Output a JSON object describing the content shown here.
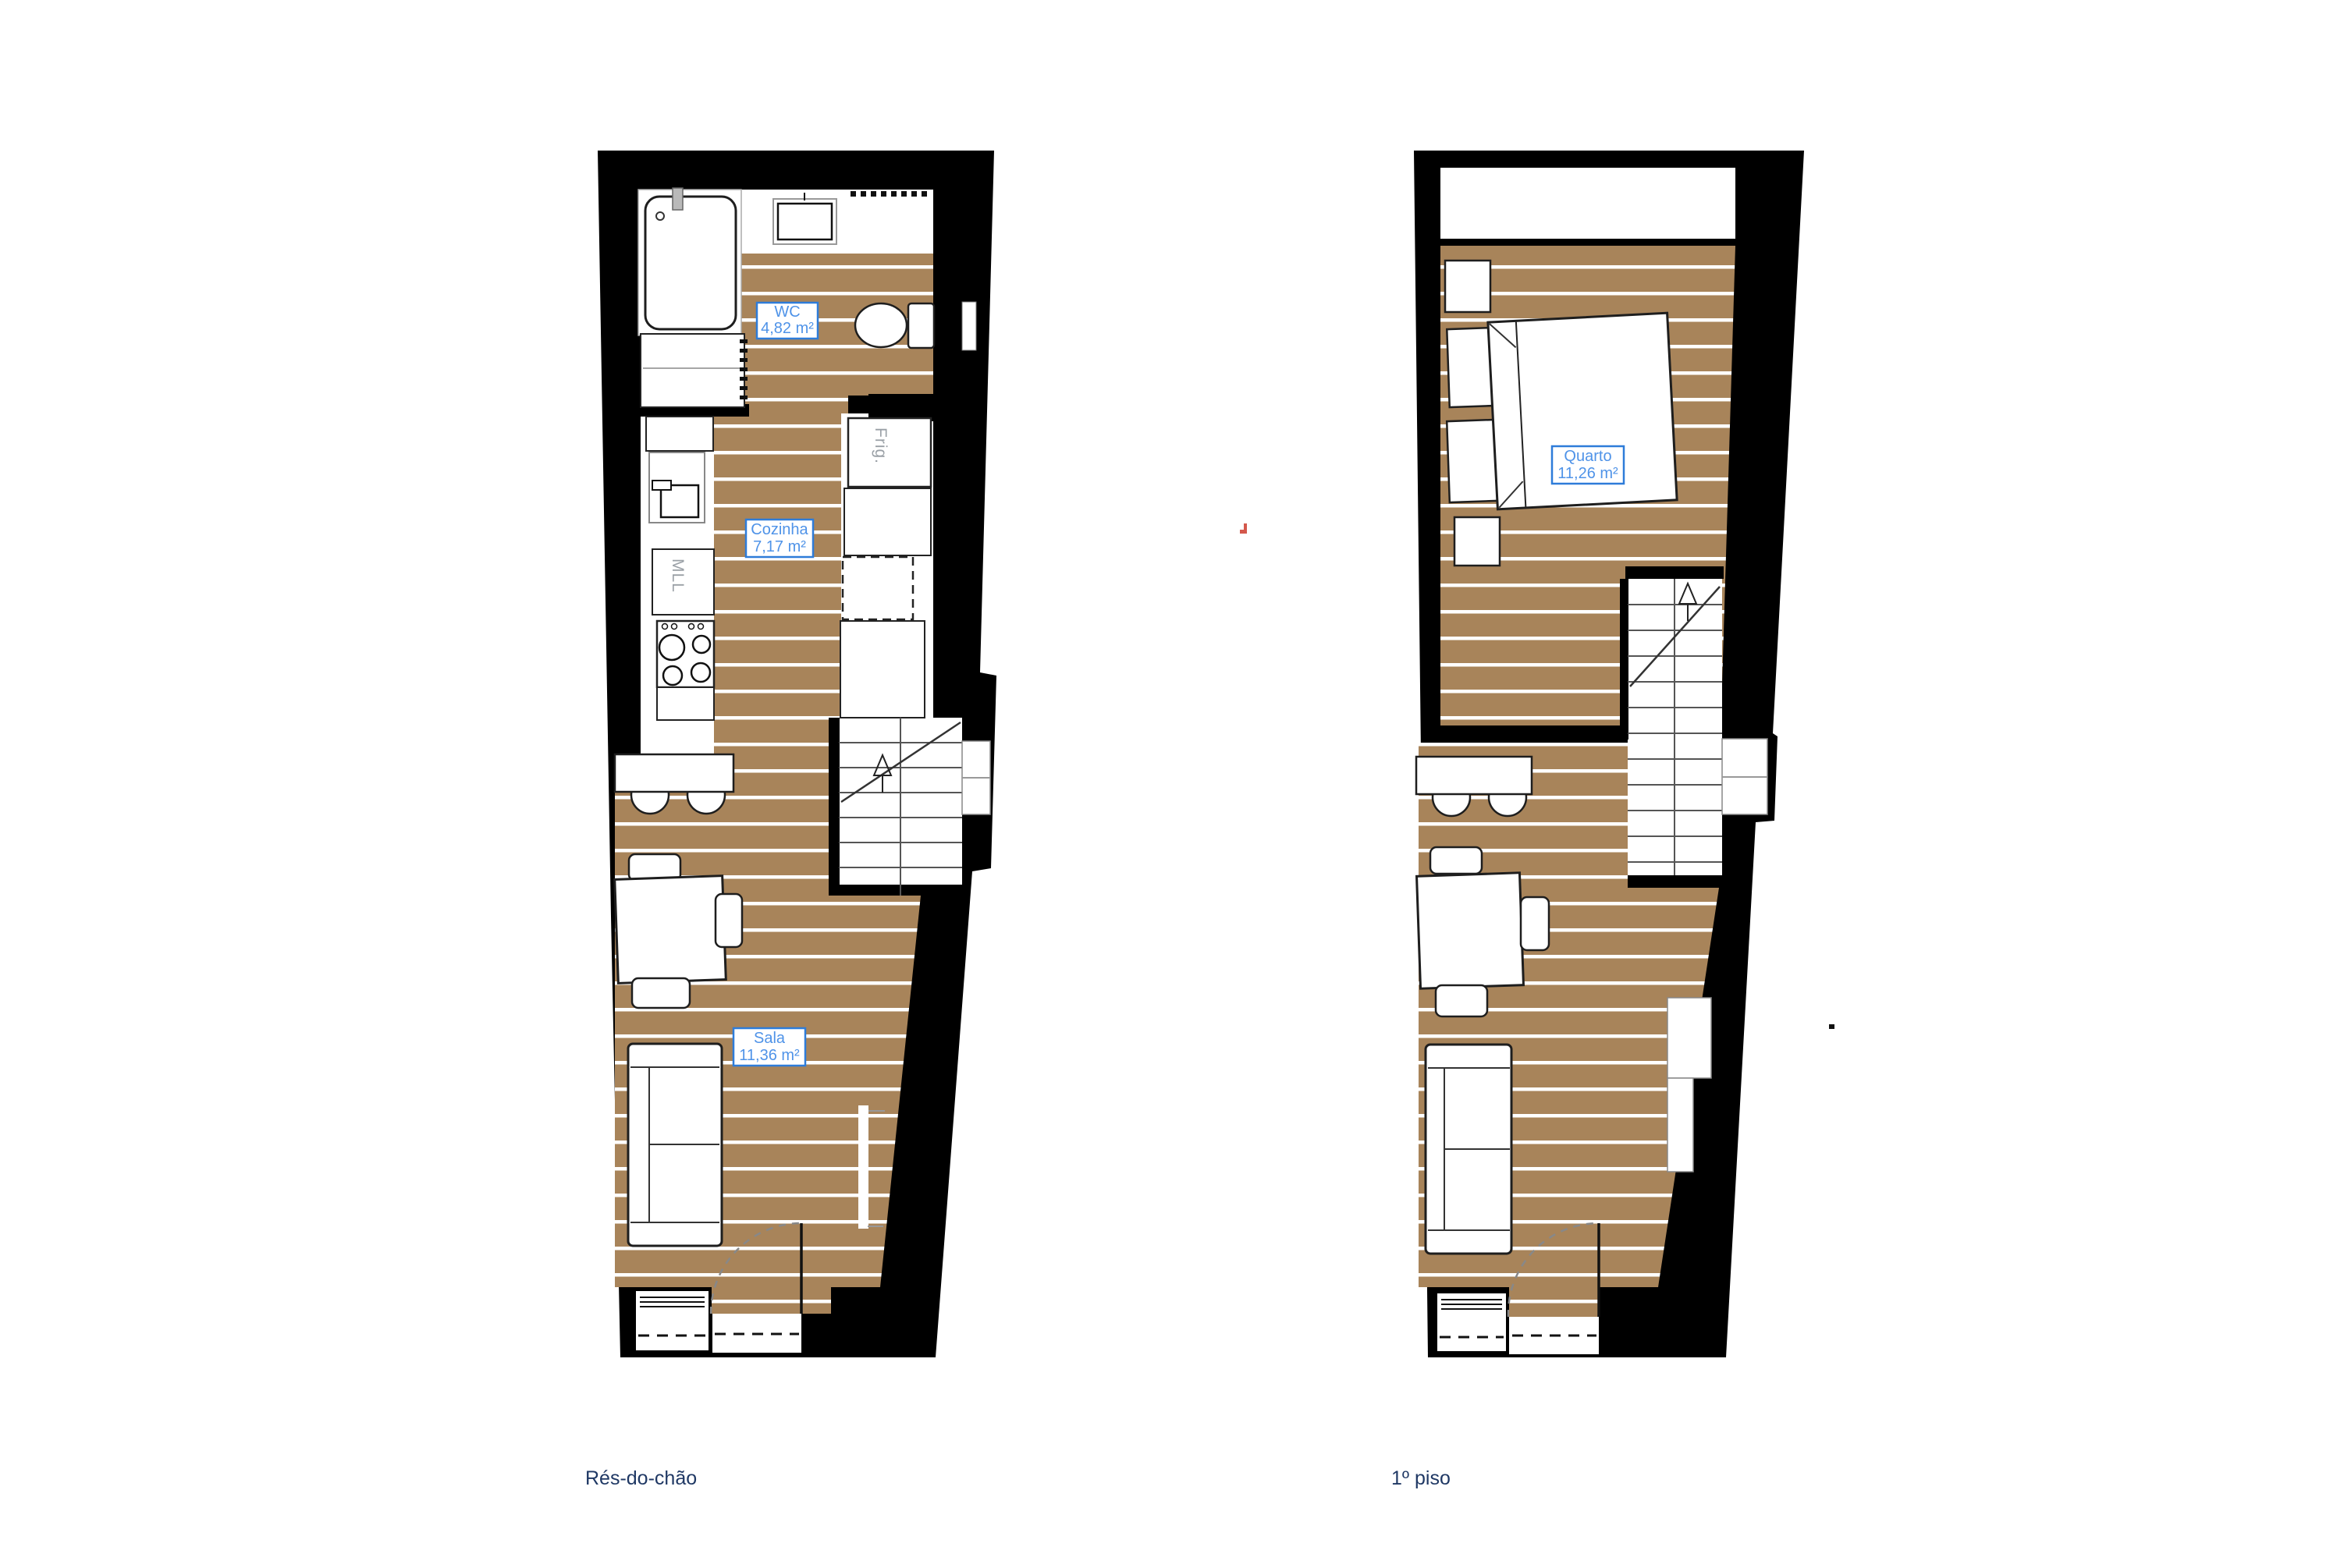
{
  "page": {
    "background": "#ffffff",
    "kind": "architectural floor plan, two storeys"
  },
  "colors": {
    "wall": "#000000",
    "wood_floor": "#a8845a",
    "plank_line": "#ffffff",
    "label_border": "#2e7cd9",
    "label_text": "#4f93e8",
    "appliance_text": "#9aa0a6",
    "caption_text": "#1f3864",
    "accent_mark": "#d4584c"
  },
  "floors": {
    "ground": {
      "caption": "Rés-do-chão",
      "rooms": {
        "wc": {
          "name": "WC",
          "area": "4,82 m²"
        },
        "cozinha": {
          "name": "Cozinha",
          "area": "7,17 m²"
        },
        "sala": {
          "name": "Sala",
          "area": "11,36 m²"
        }
      },
      "appliances": {
        "fridge": "Frig.",
        "dishwasher": "MLL"
      }
    },
    "first": {
      "caption": "1º piso",
      "rooms": {
        "quarto": {
          "name": "Quarto",
          "area": "11,26 m²"
        }
      }
    }
  }
}
